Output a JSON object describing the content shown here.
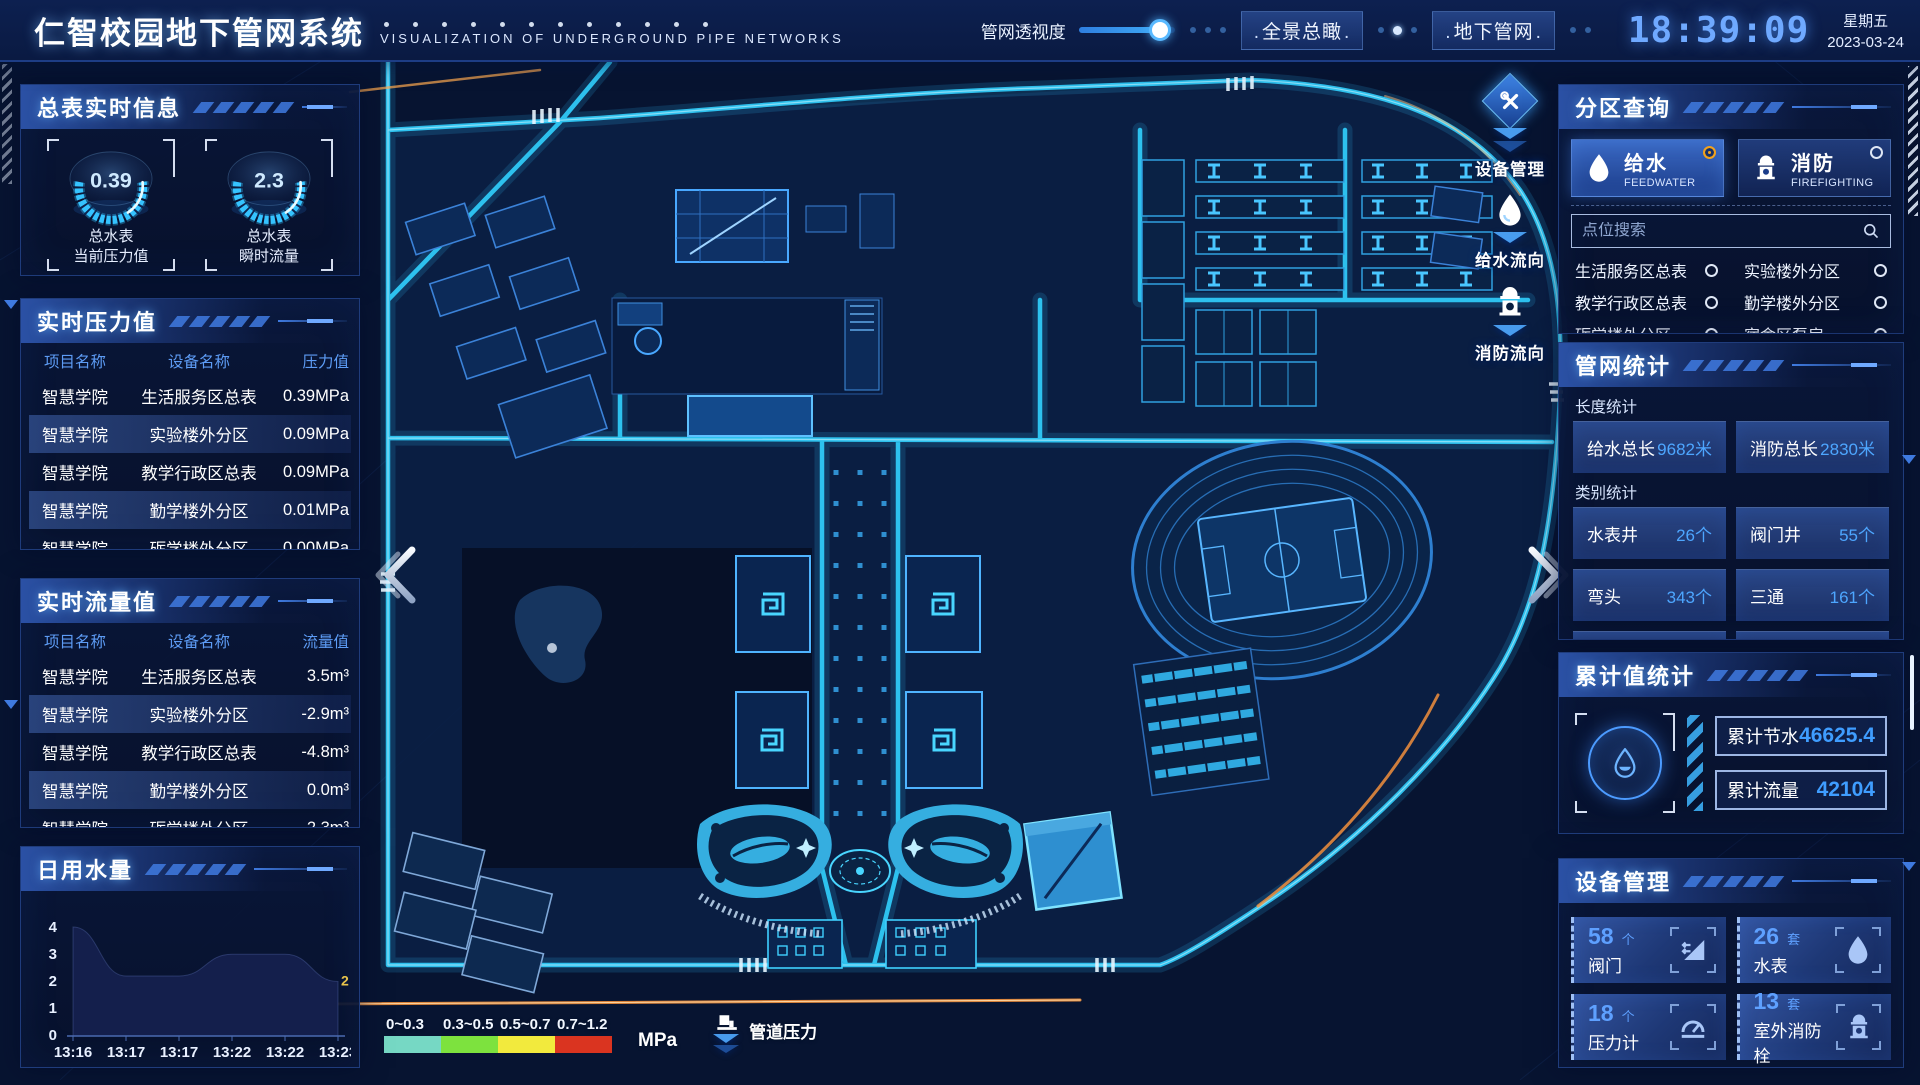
{
  "header": {
    "title": "仁智校园地下管网系统",
    "subtitle": "VISUALIZATION OF UNDERGROUND PIPE NETWORKS",
    "slider": {
      "label": "管网透视度",
      "percent": 85
    },
    "buttons": [
      {
        "label": "全景总瞰"
      },
      {
        "label": "地下管网"
      }
    ],
    "clock": {
      "time": "18:39:09",
      "weekday": "星期五",
      "date": "2023-03-24"
    }
  },
  "left": {
    "meter_info": {
      "title": "总表实时信息",
      "gauges": [
        {
          "value": "0.39",
          "line1": "总水表",
          "line2": "当前压力值"
        },
        {
          "value": "2.3",
          "line1": "总水表",
          "line2": "瞬时流量"
        }
      ]
    },
    "pressure": {
      "title": "实时压力值",
      "headers": [
        "项目名称",
        "设备名称",
        "压力值"
      ],
      "rows": [
        [
          "智慧学院",
          "生活服务区总表",
          "0.39MPa"
        ],
        [
          "智慧学院",
          "实验楼外分区",
          "0.09MPa"
        ],
        [
          "智慧学院",
          "教学行政区总表",
          "0.09MPa"
        ],
        [
          "智慧学院",
          "勤学楼外分区",
          "0.01MPa"
        ],
        [
          "智慧学院",
          "砺学楼外分区",
          "0.00MPa"
        ]
      ]
    },
    "flow": {
      "title": "实时流量值",
      "headers": [
        "项目名称",
        "设备名称",
        "流量值"
      ],
      "rows": [
        [
          "智慧学院",
          "生活服务区总表",
          "3.5m³"
        ],
        [
          "智慧学院",
          "实验楼外分区",
          "-2.9m³"
        ],
        [
          "智慧学院",
          "教学行政区总表",
          "-4.8m³"
        ],
        [
          "智慧学院",
          "勤学楼外分区",
          "0.0m³"
        ],
        [
          "智慧学院",
          "砺学楼外分区",
          "2.3m³"
        ]
      ]
    },
    "daily": {
      "title": "日用水量"
    }
  },
  "chart_data": {
    "type": "area",
    "title": "日用水量",
    "x": [
      "13:16",
      "13:17",
      "13:17",
      "13:22",
      "13:22",
      "13:23"
    ],
    "values": [
      4,
      2.2,
      2.2,
      3,
      3,
      2
    ],
    "yticks": [
      4,
      3,
      2,
      1,
      0
    ],
    "ylim": [
      0,
      4
    ],
    "end_label": "2",
    "xlabel": "",
    "ylabel": ""
  },
  "right": {
    "zone": {
      "title": "分区查询",
      "tabs": [
        {
          "name": "给水",
          "sub": "FEEDWATER",
          "selected": true
        },
        {
          "name": "消防",
          "sub": "FIREFIGHTING",
          "selected": false
        }
      ],
      "search_placeholder": "点位搜索",
      "items": [
        {
          "label": "生活服务区总表"
        },
        {
          "label": "实验楼外分区"
        },
        {
          "label": "教学行政区总表"
        },
        {
          "label": "勤学楼外分区"
        },
        {
          "label": "砺学楼外分区"
        },
        {
          "label": "宿舍区泵房"
        }
      ]
    },
    "pipe_stats": {
      "title": "管网统计",
      "length_label": "长度统计",
      "length_items": [
        {
          "label": "给水总长",
          "value": "9682米"
        },
        {
          "label": "消防总长",
          "value": "2830米"
        }
      ],
      "category_label": "类别统计",
      "category_items": [
        {
          "label": "水表井",
          "value": "26个"
        },
        {
          "label": "阀门井",
          "value": "55个"
        },
        {
          "label": "弯头",
          "value": "343个"
        },
        {
          "label": "三通",
          "value": "161个"
        }
      ]
    },
    "cumulative": {
      "title": "累计值统计",
      "items": [
        {
          "label": "累计节水",
          "value": "46625.4"
        },
        {
          "label": "累计流量",
          "value": "42104"
        }
      ]
    },
    "devices": {
      "title": "设备管理",
      "items": [
        {
          "count": "58",
          "unit": "个",
          "name": "阀门",
          "icon": "valve-icon"
        },
        {
          "count": "26",
          "unit": "套",
          "name": "水表",
          "icon": "water-meter-icon"
        },
        {
          "count": "18",
          "unit": "个",
          "name": "压力计",
          "icon": "pressure-gauge-icon"
        },
        {
          "count": "13",
          "unit": "套",
          "name": "室外消防栓",
          "icon": "hydrant-icon"
        }
      ]
    }
  },
  "map": {
    "tools": [
      {
        "label": "设备管理",
        "icon": "tools-icon"
      },
      {
        "label": "给水流向",
        "icon": "water-drop-icon"
      },
      {
        "label": "消防流向",
        "icon": "hydrant-icon"
      }
    ],
    "legend": {
      "unit": "MPa",
      "label": "管道压力",
      "ranges": [
        {
          "label": "0~0.3",
          "color": "#76d8c4"
        },
        {
          "label": "0.3~0.5",
          "color": "#7de23e"
        },
        {
          "label": "0.5~0.7",
          "color": "#f2ea3d"
        },
        {
          "label": "0.7~1.2",
          "color": "#da3420"
        }
      ]
    }
  }
}
